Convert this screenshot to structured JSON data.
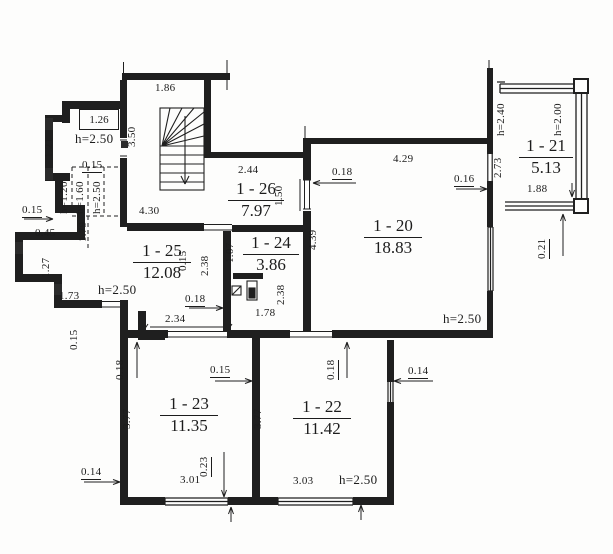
{
  "drawing": "apartment floor plan",
  "rooms": [
    {
      "id": "1 - 20",
      "area": "18.83"
    },
    {
      "id": "1 - 21",
      "area": "5.13"
    },
    {
      "id": "1 - 22",
      "area": "11.42"
    },
    {
      "id": "1 - 23",
      "area": "11.35"
    },
    {
      "id": "1 - 24",
      "area": "3.86"
    },
    {
      "id": "1 - 25",
      "area": "12.08"
    },
    {
      "id": "1 - 26",
      "area": "7.97"
    }
  ],
  "dims": {
    "entry_shelf": "1.26",
    "entry_height": "h=2.50",
    "entry_side": "1.21",
    "entry_wall": "0.15",
    "closet_h1": "h=1.20",
    "closet_h2": "h=1.60",
    "closet_h3": "h=2.50",
    "closet_depth": "1.79",
    "stair_width": "1.86",
    "stair_depth": "3.50",
    "hall_length": "4.30",
    "left_step": "0.15",
    "left_recess": "0.45",
    "left_side": "1.27",
    "porch_width": "1.73",
    "lobby_height": "h=2.50",
    "r26_width": "2.44",
    "r26_door": "1.50",
    "r26_wall": "0.18",
    "r25_wall": "0.15",
    "r25_side": "2.38",
    "r25_door": "0.18",
    "r25_width": "2.34",
    "r25_wall2": "0.15",
    "r24_door": "1.07",
    "r24_side": "2.38",
    "r24_width": "1.78",
    "r20_width": "4.29",
    "r20_side": "4.39",
    "r20_wall": "0.16",
    "r20_height": "h=2.50",
    "balc_h1": "h=2.40",
    "balc_h2": "h=2.00",
    "balc_side": "2.73",
    "balc_width": "1.88",
    "balc_wall": "0.21",
    "r23_door": "0.18",
    "r23_wall": "0.15",
    "r23_side": "3.77",
    "r23_width": "3.01",
    "r23_pier": "0.23",
    "bottom_wall": "0.14",
    "r22_side": "3.77",
    "r22_door": "0.18",
    "r22_wall": "0.14",
    "r22_width": "3.03",
    "r22_height": "h=2.50"
  }
}
